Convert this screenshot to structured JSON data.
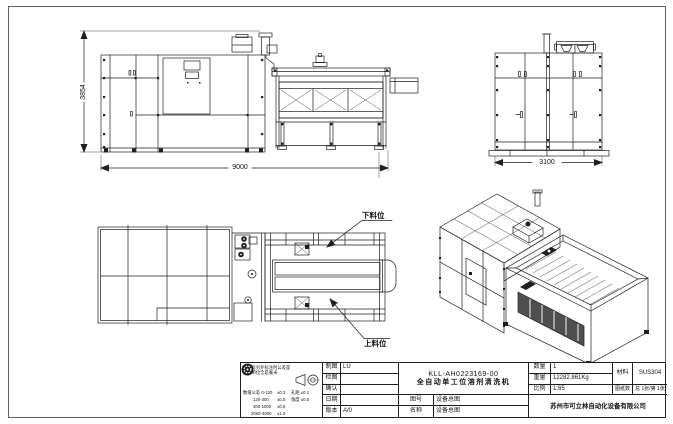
{
  "colors": {
    "highlight_box": "#9bbf9b",
    "line": "#1f1f1f"
  },
  "views": {
    "front": {
      "dim_height": "3854",
      "dim_length": "9000"
    },
    "side": {
      "dim_width": "3100"
    },
    "plan": {
      "label_unload": "下料位",
      "label_load": "上料位"
    }
  },
  "titleblock": {
    "tol": {
      "note1": "在没有另外标注时公差是",
      "note2": "尺寸单位全是毫米",
      "r1a": "数值公差 0-120",
      "r1b": "±0.3",
      "r1c": "孔距 ±0.1",
      "r2a": "120-400",
      "r2b": "±0.5",
      "r2c": "角度 ±0.5",
      "r3a": "400-1000",
      "r3b": "±0.8",
      "r4a": "2000-4000",
      "r4b": "±1.0"
    },
    "drawn_label": "制图",
    "drawn_value": "LU",
    "checked_label": "检图",
    "approved_label": "确认",
    "date_label": "日期",
    "version_label": "版本",
    "version_value": "A/0",
    "drawing_code": "KLL-AH0223169-00",
    "product_name": "全自动单工位溶剂清洗机",
    "figno_label": "图号",
    "figno_value": "设备总图",
    "name_label": "名称",
    "name_value": "设备总图",
    "qty_label": "数量",
    "qty_value": "1",
    "weight_label": "重量",
    "weight_value": "12282.861Kg",
    "scale_label": "比例",
    "scale_value": "1:65",
    "material_label": "材料",
    "material_value": "SUS304",
    "sheets_label": "图纸数",
    "sheets_value": "总 1张/第 1张",
    "company": "苏州市可立林自动化设备有限公司"
  }
}
